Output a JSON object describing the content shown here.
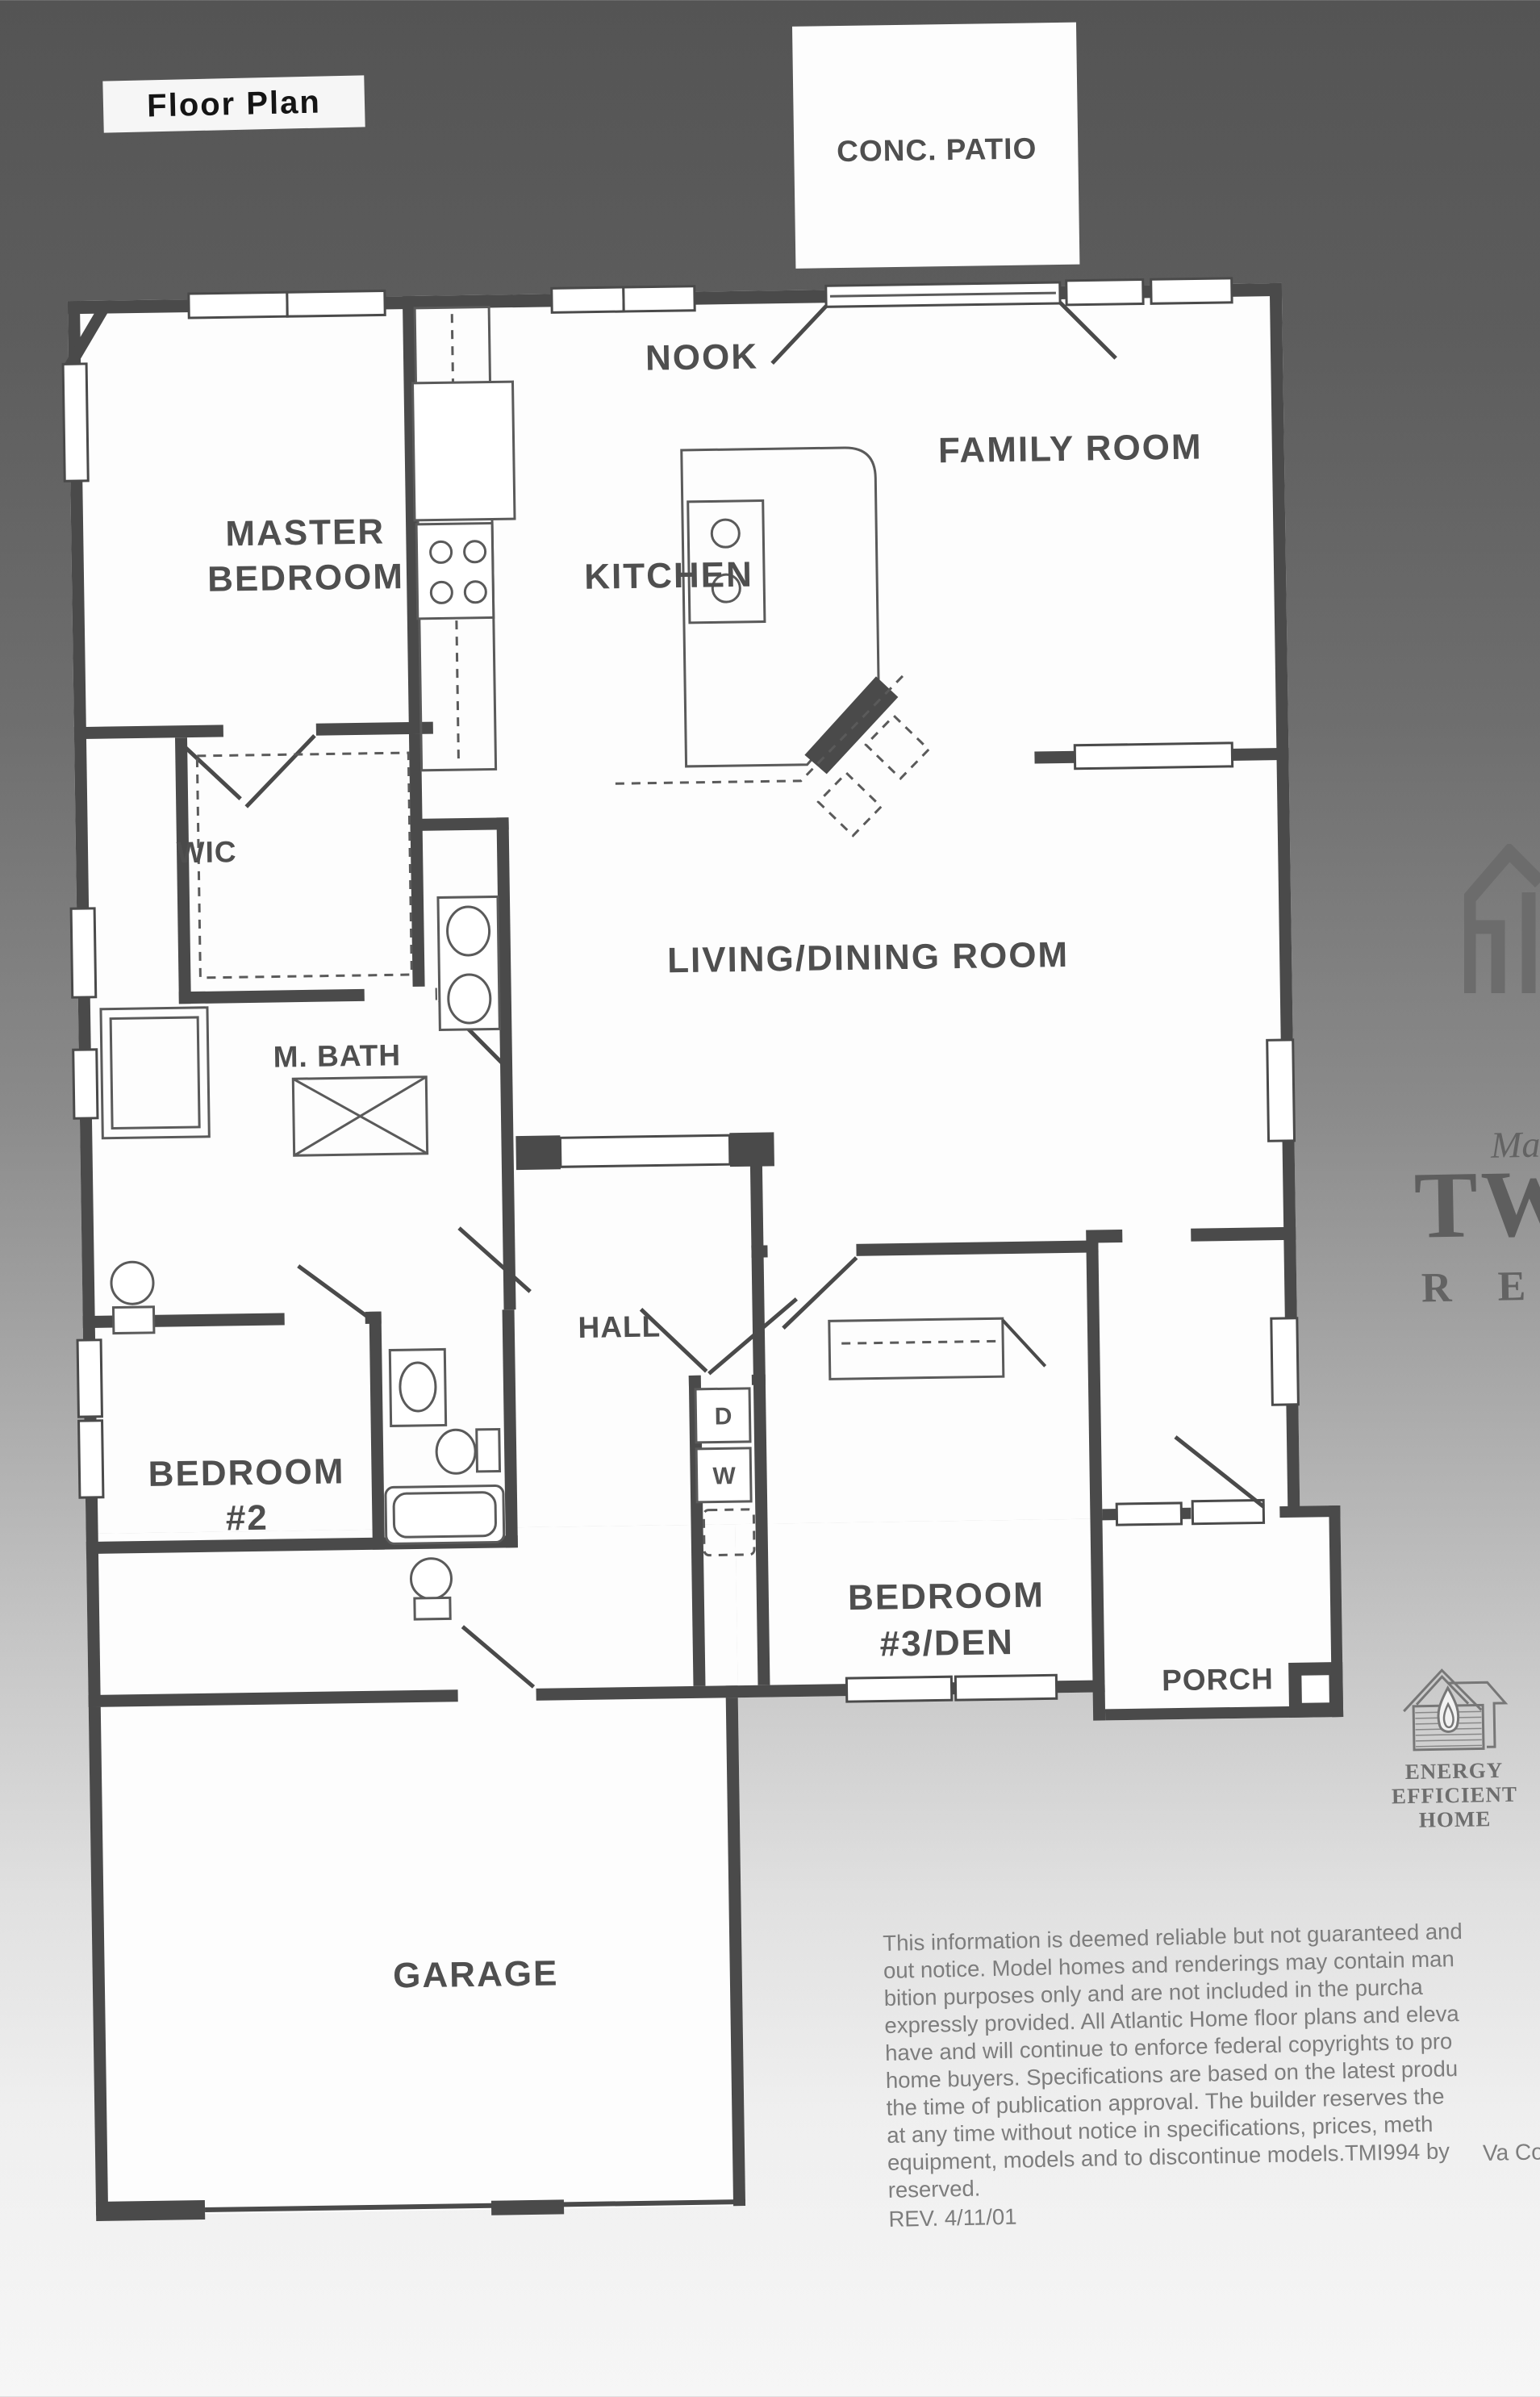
{
  "title": "Floor Plan",
  "rooms": {
    "conc_patio": "CONC. PATIO",
    "nook": "NOOK",
    "family_room": "FAMILY ROOM",
    "master_bedroom": [
      "MASTER",
      "BEDROOM"
    ],
    "kitchen": "KITCHEN",
    "wic": "WIC",
    "m_bath": "M. BATH",
    "living_dining": "LIVING/DINING ROOM",
    "hall": "HALL",
    "bedroom_2": [
      "BEDROOM",
      "#2"
    ],
    "bedroom_3_den": [
      "BEDROOM",
      "#3/DEN"
    ],
    "porch": "PORCH",
    "garage": "GARAGE"
  },
  "appliances": {
    "dryer": "D",
    "washer": "W"
  },
  "brand": {
    "prefix": "Mar",
    "word": "TW",
    "sub": "R E"
  },
  "energy_logo": {
    "line1": "ENERGY",
    "line2": "EFFICIENT",
    "line3": "HOME"
  },
  "disclaimer": {
    "lines": [
      "This information is deemed reliable but not guaranteed and",
      "out notice. Model homes and renderings may contain man",
      "bition purposes only and are not included in the purcha",
      "expressly provided. All Atlantic Home floor plans and eleva",
      "have and will continue to enforce federal copyrights to pro",
      "home buyers. Specifications are based on the latest produ",
      "the time of publication approval. The builder reserves the",
      "at any time without notice in specifications, prices, meth",
      "equipment, models and to discontinue models.TMI994 by",
      "reserved."
    ],
    "rev": "REV. 4/11/01",
    "corner_note": "Va Con"
  },
  "colors": {
    "wall": "#4a4a4a",
    "label": "#4f4f4f",
    "paper": "#ffffff",
    "bg_top": "#545454",
    "bg_bottom": "#f6f6f6",
    "disclaimer_text": "#7d7d7d",
    "brand_gray": "#636363"
  }
}
